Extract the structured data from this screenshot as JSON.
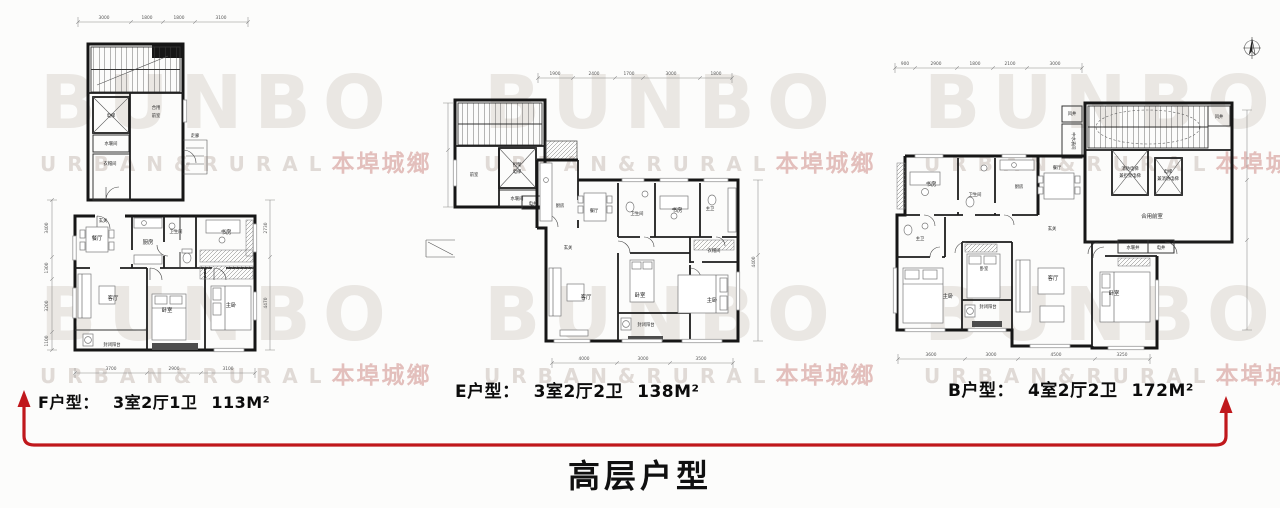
{
  "watermark": {
    "brand": "BUNBO",
    "latin": "U R B A N  &  R U R A L",
    "cn": "本埠城鄉"
  },
  "title": "高层户型",
  "plans": [
    {
      "id": "F",
      "caption": {
        "name": "F户型：",
        "layout": "3室2厅1卫",
        "area": "113M²"
      },
      "dims_top": [
        "3000",
        "1800",
        "1800",
        "3100"
      ],
      "dims_bottom": [
        "3700",
        "2900",
        "3100"
      ],
      "dims_left": [
        "3400",
        "1300",
        "3200",
        "1100"
      ],
      "dims_right": [
        "2730",
        "4470"
      ],
      "rooms": {
        "elevator": "电梯",
        "water": "水暖间",
        "vest1": "合用",
        "vest2": "前室",
        "ward": "衣帽间",
        "corridor": "走廊",
        "entry": "玄关",
        "dining": "餐厅",
        "kitchen": "厨房",
        "bath": "卫生间",
        "study": "书房",
        "living": "客厅",
        "bed": "卧室",
        "master": "主卧",
        "balcony": "封闭阳台"
      }
    },
    {
      "id": "E",
      "caption": {
        "name": "E户型：",
        "layout": "3室2厅2卫",
        "area": "138M²"
      },
      "dims_top": [
        "1900",
        "2400",
        "1700",
        "3000",
        "1800"
      ],
      "dims_bottom": [
        "4000",
        "3000",
        "3500"
      ],
      "dims_right": [
        "4400"
      ],
      "rooms": {
        "front": "前室",
        "lift1": "担架",
        "lift2": "电梯",
        "water": "水暖间",
        "eshaft": "电井",
        "kitchen": "厨房",
        "dining": "餐厅",
        "entry": "玄关",
        "bath": "卫生间",
        "study": "书房",
        "mbath": "主卫",
        "living": "客厅",
        "bed": "卧室",
        "master": "主卧",
        "closet": "衣帽间",
        "balcony": "封闭阳台"
      }
    },
    {
      "id": "B",
      "caption": {
        "name": "B户型：",
        "layout": "4室2厅2卫",
        "area": "172M²"
      },
      "dims_top": [
        "900",
        "2900",
        "1800",
        "2100",
        "3000"
      ],
      "dims_bottom": [
        "3600",
        "3000",
        "4500",
        "3250"
      ],
      "rooms": {
        "shaft_l": "风井",
        "shaft_r": "风井",
        "midwater": "中水表间",
        "fire1": "消防电梯",
        "fire2": "兼担架电梯",
        "lift1": "电梯",
        "lift2": "兼消防电梯",
        "lobby": "合用前室",
        "study": "书房",
        "bath": "卫生间",
        "kitchen": "厨房",
        "dining": "餐厅",
        "entry": "玄关",
        "mbath": "主卫",
        "master": "主卧",
        "bed2": "卧室",
        "balcony": "封闭阳台",
        "living": "客厅",
        "bed3": "卧室",
        "wshaft": "水暖井",
        "eshaft": "电井"
      }
    }
  ]
}
